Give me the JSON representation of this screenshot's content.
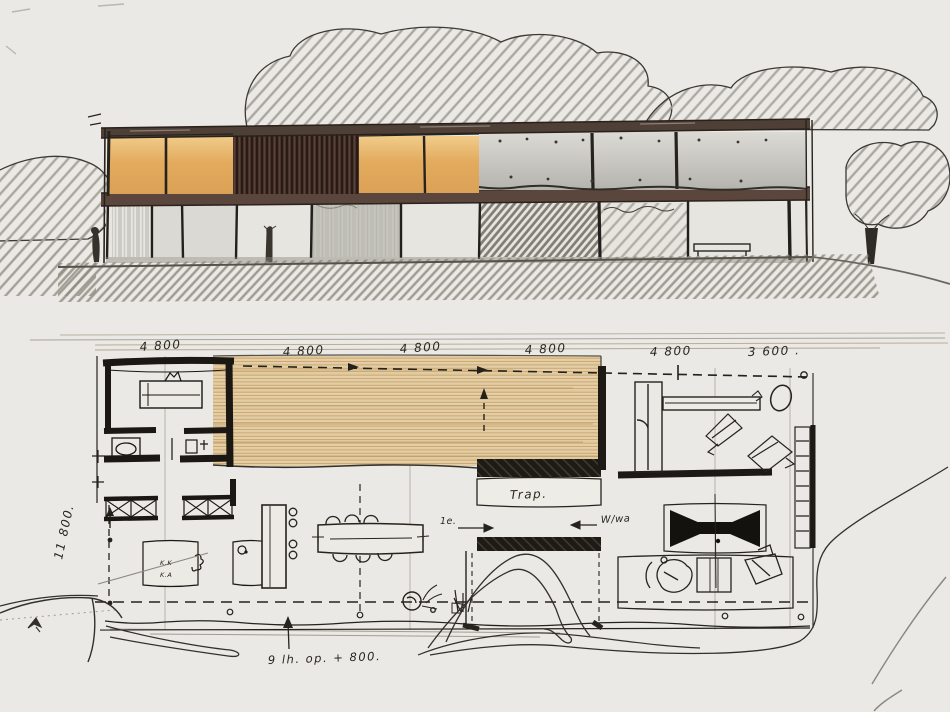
{
  "meta": {
    "title": "Hand-drawn architectural sketch: front elevation (top) and ground floor plan (bottom) of a long two-storey modern house",
    "drawing_type": "concept sketch, ink and marker on paper"
  },
  "colors": {
    "paper": "#eae9e5",
    "ink": "#26231d",
    "pencil": "#8f8c82",
    "panel_orange": "#e0a95e",
    "panel_slat_brown": "#46322a",
    "roof_band_brown": "#4e3f37",
    "glass_gray": "#c5c3bd",
    "deck_tan": "#e9d7b0",
    "deck_stripe": "#c49f6b"
  },
  "plan": {
    "dims_top": [
      "4 800",
      "4 800",
      "4 800",
      "4 800",
      "4 800",
      "3 600 ."
    ],
    "dim_left": "11 800.",
    "labels": {
      "stairs": "Trap.",
      "level": "1e.",
      "utility": "W/wa",
      "bottom_note": "9 lh. op. + 800.",
      "room_code_1": "K.K",
      "room_code_2": "K.A"
    }
  }
}
